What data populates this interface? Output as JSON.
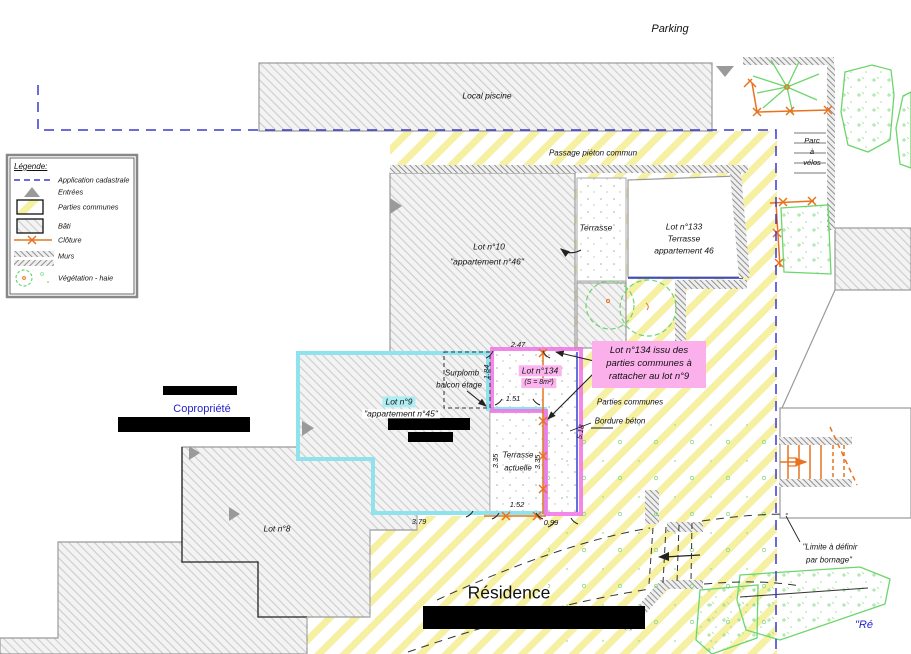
{
  "legend": {
    "title": "Légende:",
    "items": [
      {
        "label": "Application cadastrale",
        "icon": "blue-dashed-line"
      },
      {
        "label": "Entrées",
        "icon": "gray-triangle"
      },
      {
        "label": "Parties communes",
        "icon": "yellow-hatch-box"
      },
      {
        "label": "Bâti",
        "icon": "gray-hatch-box"
      },
      {
        "label": "Clôture",
        "icon": "orange-fence-line"
      },
      {
        "label": "Murs",
        "icon": "wall-hatch"
      },
      {
        "label": "Végétation - haie",
        "icon": "green-vegetation"
      }
    ]
  },
  "site": {
    "parking": "Parking",
    "local_piscine": "Local piscine",
    "passage_pieton": "Passage piéton commun",
    "parc_velos_l1": "Parc",
    "parc_velos_l2": "à",
    "parc_velos_l3": "vélos",
    "residence": "Résidence",
    "copropriete": "Copropriété",
    "residence_corner": "\"Ré",
    "limite_l1": "\"Limite à définir",
    "limite_l2": "par bornage\""
  },
  "lots": {
    "lot10_l1": "Lot n°10",
    "lot10_l2": "\"appartement  n°46\"",
    "lot133_l1": "Lot n°133",
    "lot133_l2": "Terrasse",
    "lot133_l3": "appartement 46",
    "lot9_l1": "Lot n°9",
    "lot9_l2": "\"appartement  n°45\"",
    "lot134_l1": "Lot n°134",
    "lot134_l2": "(S = 8m²)",
    "lot8": "Lot n°8",
    "terrasse": "Terrasse",
    "terrasse_actuelle_l1": "Terrasse",
    "terrasse_actuelle_l2": "actuelle"
  },
  "annotations": {
    "surplomb_l1": "Surplomb",
    "surplomb_l2": "balcon étage",
    "callout_l1": "Lot n°134 issu des",
    "callout_l2": "parties communes à",
    "callout_l3": "rattacher au lot n°9",
    "parties_communes": "Parties communes",
    "bordure_beton": "Bordure béton"
  },
  "dimensions": {
    "top": "2.47",
    "left": "1.84",
    "middle": "1.51",
    "terrace_left": "3.35",
    "terrace_right": "3.35",
    "right_side": "5.18",
    "bottom_left": "3.79",
    "bottom_middle": "1.52",
    "bottom_right": "0.99"
  },
  "colors": {
    "cadastral_blue": "#3a3ad0",
    "common_yellow": "#f6f1a6",
    "fence_orange": "#e8731e",
    "lot9_cyan": "#8fe3ec",
    "lot134_pink": "#f273e6",
    "highlight_pink": "#fbb4ee",
    "vegetation_green": "#6cd66c",
    "text_blue": "#2323c8"
  }
}
